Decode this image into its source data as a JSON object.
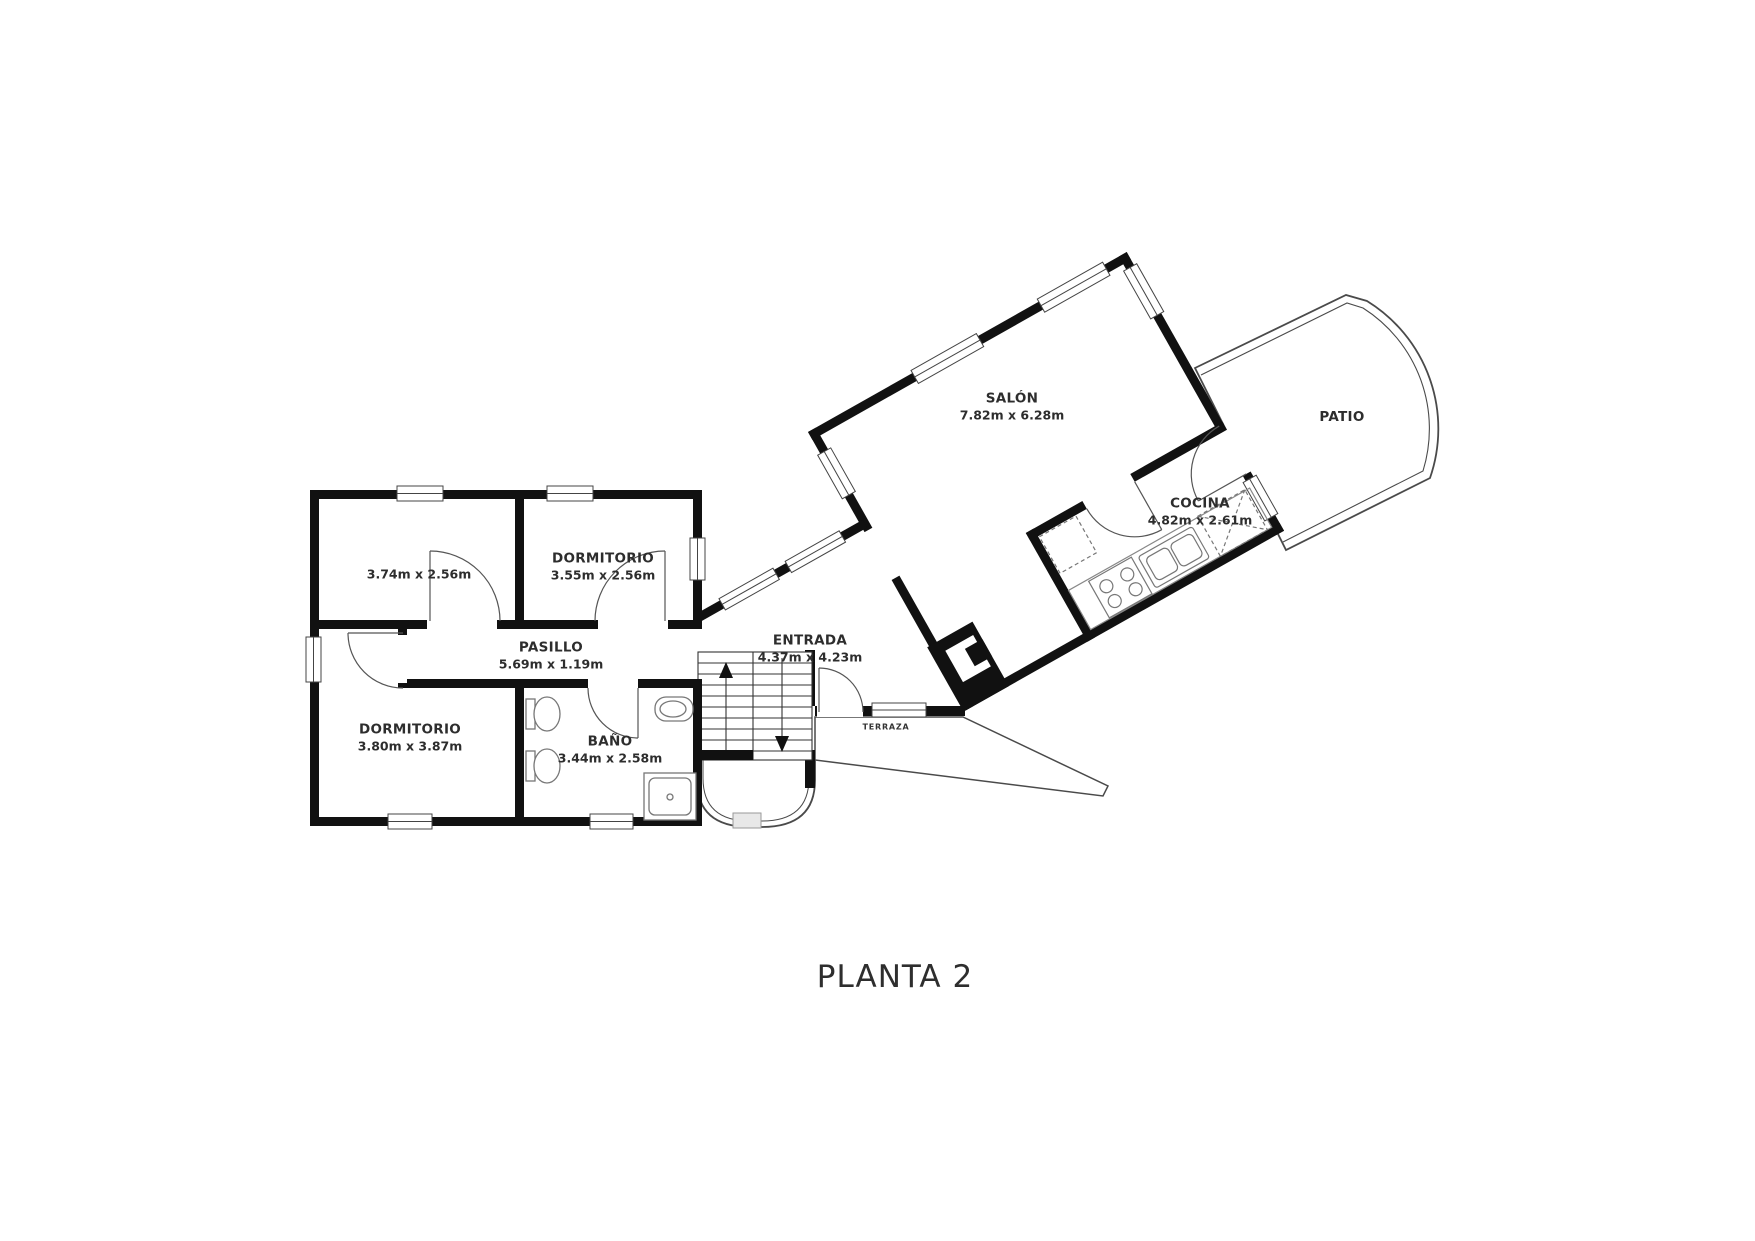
{
  "title": "PLANTA 2",
  "rooms": {
    "salon": {
      "name": "SALÓN",
      "dims": "7.82m x 6.28m"
    },
    "cocina": {
      "name": "COCINA",
      "dims": "4.82m x 2.61m"
    },
    "patio": {
      "name": "PATIO"
    },
    "terraza": {
      "name": "TERRAZA"
    },
    "dormitorio1": {
      "name": "DORMITORIO",
      "dims": "3.55m x 2.56m"
    },
    "room_small": {
      "dims": "3.74m x 2.56m"
    },
    "pasillo": {
      "name": "PASILLO",
      "dims": "5.69m x 1.19m"
    },
    "entrada": {
      "name": "ENTRADA",
      "dims": "4.37m x 4.23m"
    },
    "dormitorio2": {
      "name": "DORMITORIO",
      "dims": "3.80m x 3.87m"
    },
    "bano": {
      "name": "BAÑO",
      "dims": "3.44m x 2.58m"
    }
  },
  "colors": {
    "wall": "#111111",
    "thin_line": "#4a4a4a",
    "background": "#ffffff"
  }
}
